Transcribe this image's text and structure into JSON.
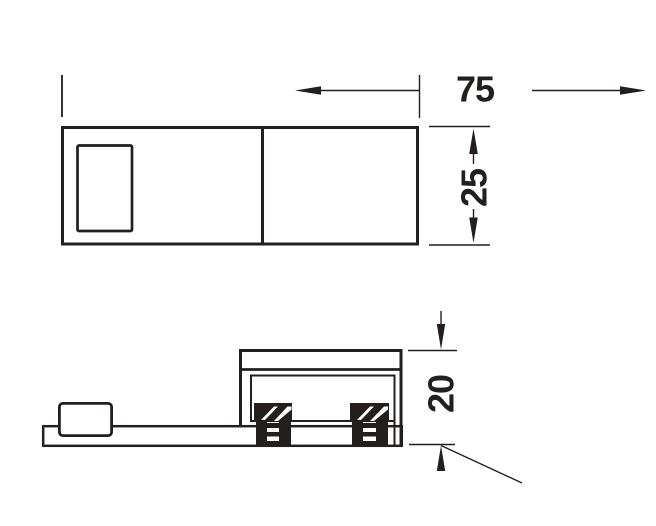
{
  "drawing": {
    "type": "technical-dimension-drawing",
    "ink_color": "#241f1e",
    "background": "#ffffff",
    "dimensions": {
      "width": "75",
      "depth": "25",
      "height": "20"
    }
  }
}
